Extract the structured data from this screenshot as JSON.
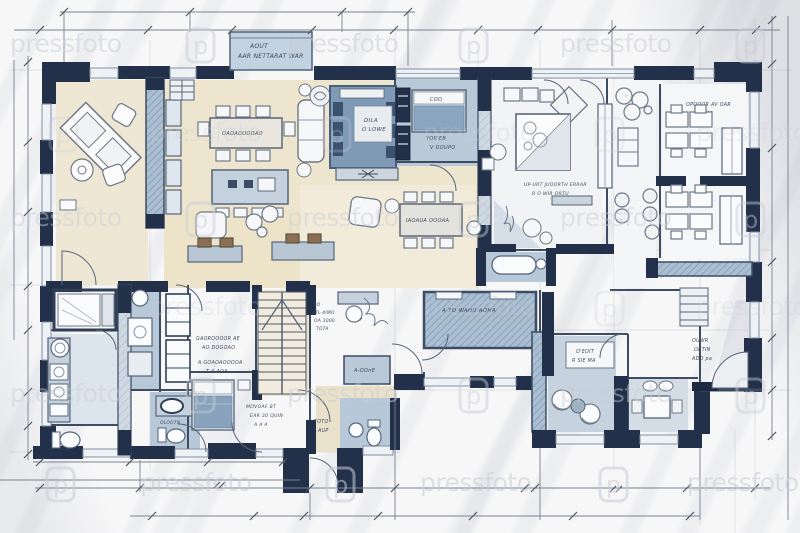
{
  "watermark": {
    "text": "pressfoto",
    "logo_letter": "p"
  },
  "title_block": {
    "line1": "AOUT",
    "line2": "AAR NETTARAT WAR"
  },
  "rooms": {
    "dining": {
      "table_label": "OAOAOOOOAO"
    },
    "dining2": {
      "table_label": "IAOAUA OOOAA"
    },
    "living": {
      "rug_line1": "DILA",
      "rug_line2": "O LOWE"
    },
    "bedroom_guest": {
      "pillow": "COO",
      "line1": "YOR'EB",
      "line2": "V DOUPO"
    },
    "bedroom_master": {
      "line1": "UP-URT JUOORTH ERRAR",
      "line2": "R O WIR ORTU"
    },
    "office": {
      "line1": "OPQOOR AV OAR",
      "line2": "R 401"
    },
    "hall": {
      "line1": "GAOROOOOR AE",
      "line2": "AO DOGOAO",
      "line3": "A GOAOAOOOOA",
      "line4": "T A AOA"
    },
    "bedroom_small": {
      "line1": "MOVOAF BT",
      "line2": "EAR 30 QUIN",
      "line3": "A A A"
    },
    "study_nook": {
      "line1": "LO",
      "line2": "ATL-4IMO",
      "line3": "OA 3000",
      "line4": "TOTA"
    },
    "terrace": {
      "label": "A TO WAHU AOHA"
    },
    "closet": {
      "label": "A-OOnE"
    },
    "sitting_nook": {
      "line1": "O'EOIT",
      "line2": "R SIE MA"
    },
    "hall_right": {
      "line1": "OUWR",
      "line2": "ORTIN",
      "line3": "ADO pa"
    },
    "bath_entry": {
      "line1": "TOTO",
      "line2": "AUP"
    },
    "bath_left": {
      "label": "OLOOTN"
    }
  },
  "colors": {
    "wall_dark": "#22304a",
    "wall_mid": "#3d4c61",
    "wash_blue": "#a9bdd0",
    "wash_blue_light": "#c6d3de",
    "rug_blue": "#7e9ab5",
    "bed_blue": "#8ba6bf",
    "floor_cream": "#ede5cd",
    "paper": "#f7f7f8",
    "ink": "#4b5565",
    "watermark": "#c9cdd5"
  }
}
